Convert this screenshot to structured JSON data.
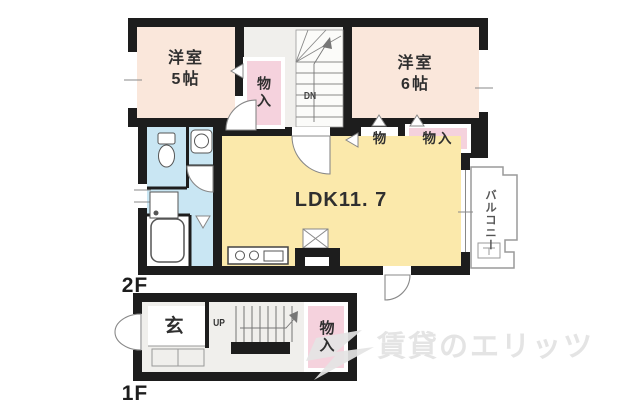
{
  "floorplan": {
    "floor2": {
      "label": "2F",
      "bedroom_left": {
        "text": "洋室\n5帖"
      },
      "bedroom_right": {
        "text": "洋室\n6帖"
      },
      "ldk": {
        "text": "LDK11. 7"
      },
      "balcony": {
        "text": "バルコニー"
      },
      "closet_hall": {
        "text": "物入"
      },
      "closet_mono": {
        "text": "物"
      },
      "closet_right": {
        "text": "物入"
      },
      "stairs_down": {
        "text": "DN"
      }
    },
    "floor1": {
      "label": "1F",
      "entrance": {
        "text": "玄"
      },
      "stairs_up": {
        "text": "UP"
      },
      "closet": {
        "text": "物入"
      }
    },
    "watermark": {
      "text": "賃貸のエリッツ"
    },
    "colors": {
      "wall": "#1d1d1d",
      "bedroom_peach": "#FAE7DB",
      "ldk_yellow": "#FBE9AB",
      "closet_pink": "#F5D2DD",
      "sanitary_blue": "#C9E6F3",
      "hall_gray": "#F0EFEC",
      "watermark_gray": "#E4E4E4"
    }
  }
}
